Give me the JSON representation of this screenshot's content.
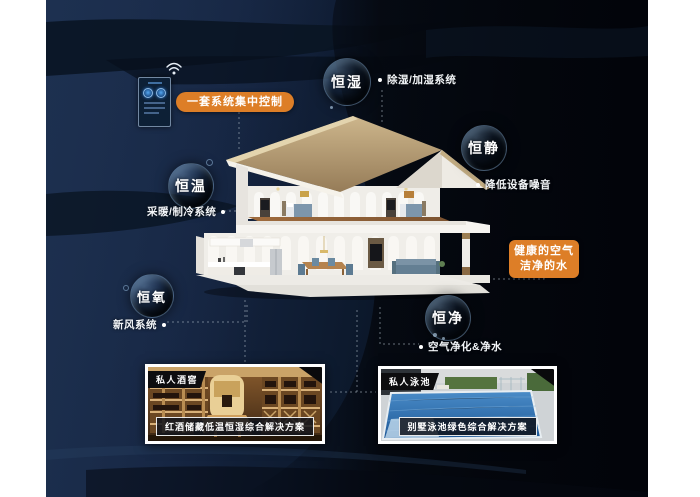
{
  "scene": {
    "control_label": "一套系统集中控制",
    "benefit_line1": "健康的空气",
    "benefit_line2": "洁净的水"
  },
  "bubbles": {
    "humidity": {
      "label": "恒湿",
      "sub": "除湿/加湿系统"
    },
    "quiet": {
      "label": "恒静",
      "sub": "降低设备噪音"
    },
    "temperature": {
      "label": "恒温",
      "sub": "采暖/制冷系统"
    },
    "oxygen": {
      "label": "恒氧",
      "sub": "新风系统"
    },
    "purity": {
      "label": "恒净",
      "sub": "空气净化&净水"
    }
  },
  "photos": {
    "wine": {
      "tag": "私人酒窖",
      "caption": "红酒储藏低温恒湿综合解决方案"
    },
    "pool": {
      "tag": "私人泳池",
      "caption": "别墅泳池绿色综合解决方案"
    }
  },
  "icons": {
    "wifi": "wifi-icon",
    "control_panel": "smart-home-control-panel"
  },
  "colors": {
    "accent_orange": "#dd7e27",
    "background_navy": "#16273f",
    "bubble_rim": "#8fbce8",
    "text_white": "#ffffff"
  }
}
